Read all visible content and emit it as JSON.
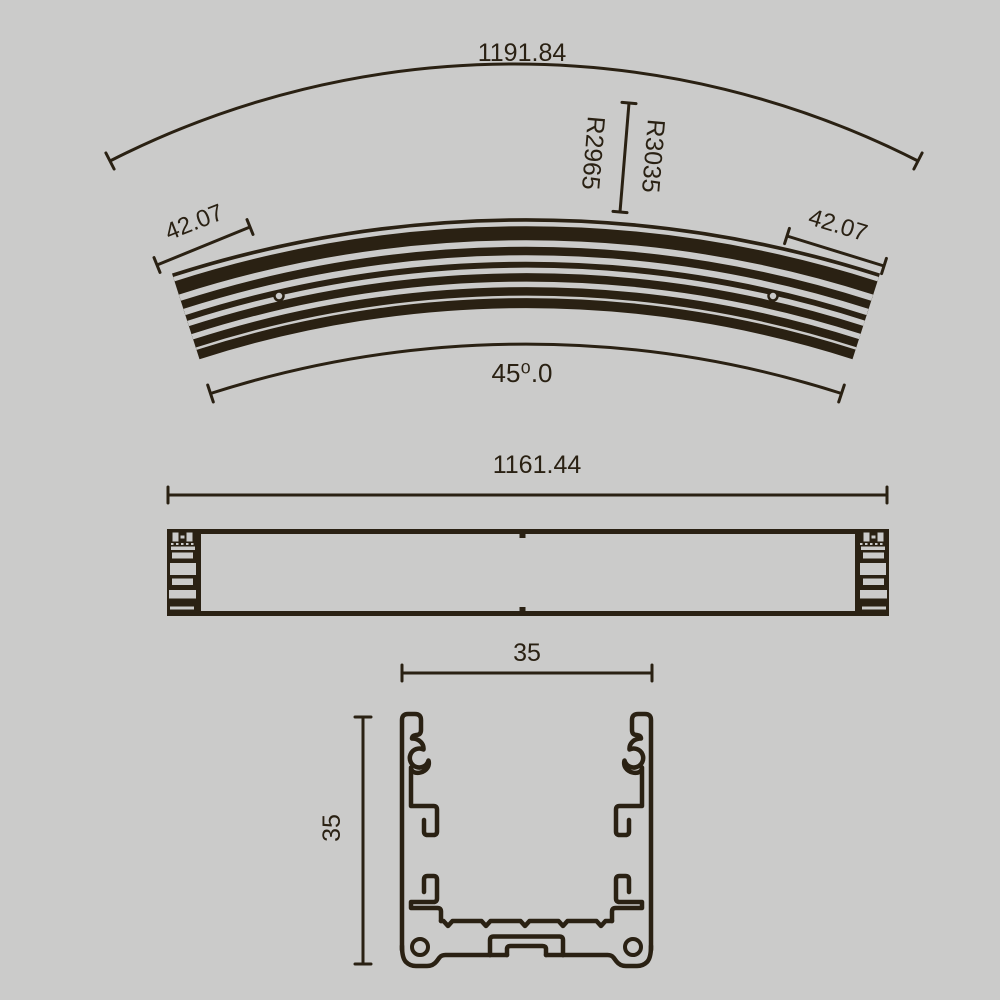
{
  "colors": {
    "background": "#cbcbca",
    "ink": "#2a2113"
  },
  "top_view": {
    "dim_arc_length": "1191.84",
    "dim_radius_outer": "R3035",
    "dim_radius_inner": "R2965",
    "dim_end_width_left": "42.07",
    "dim_end_width_right": "42.07",
    "dim_angle": "45⁰.0"
  },
  "side_view": {
    "dim_length": "1161.44"
  },
  "section_view": {
    "dim_width": "35",
    "dim_height": "35"
  }
}
